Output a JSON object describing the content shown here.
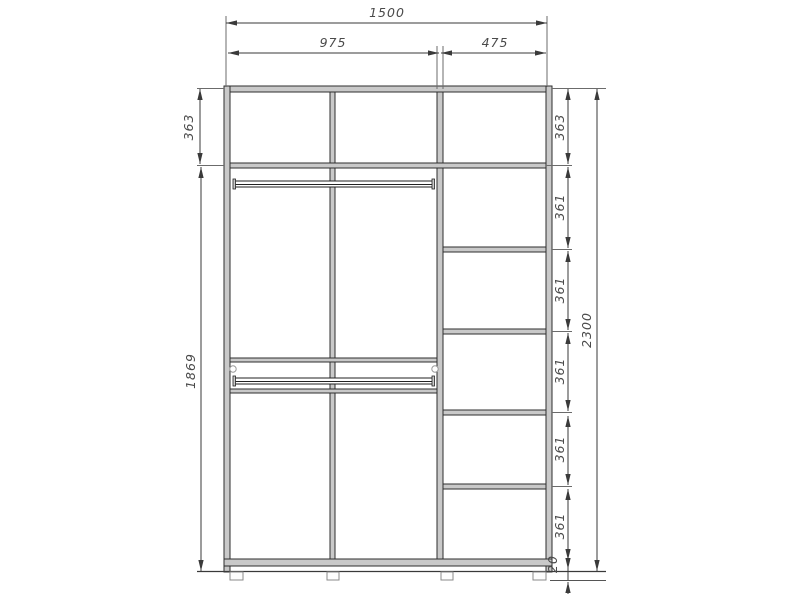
{
  "dims": {
    "total_width": "1500",
    "left_width": "975",
    "right_width": "475",
    "left_top": "363",
    "left_body": "1869",
    "right_stack": [
      "363",
      "361",
      "361",
      "361",
      "361",
      "361"
    ],
    "total_height": "2300",
    "feet_gap": "20"
  },
  "colors": {
    "dimension_line": "#3a3a3a",
    "panel_fill": "#c9c9c9",
    "panel_edge": "#2e2e2e",
    "label_text": "#4a4a4a"
  }
}
